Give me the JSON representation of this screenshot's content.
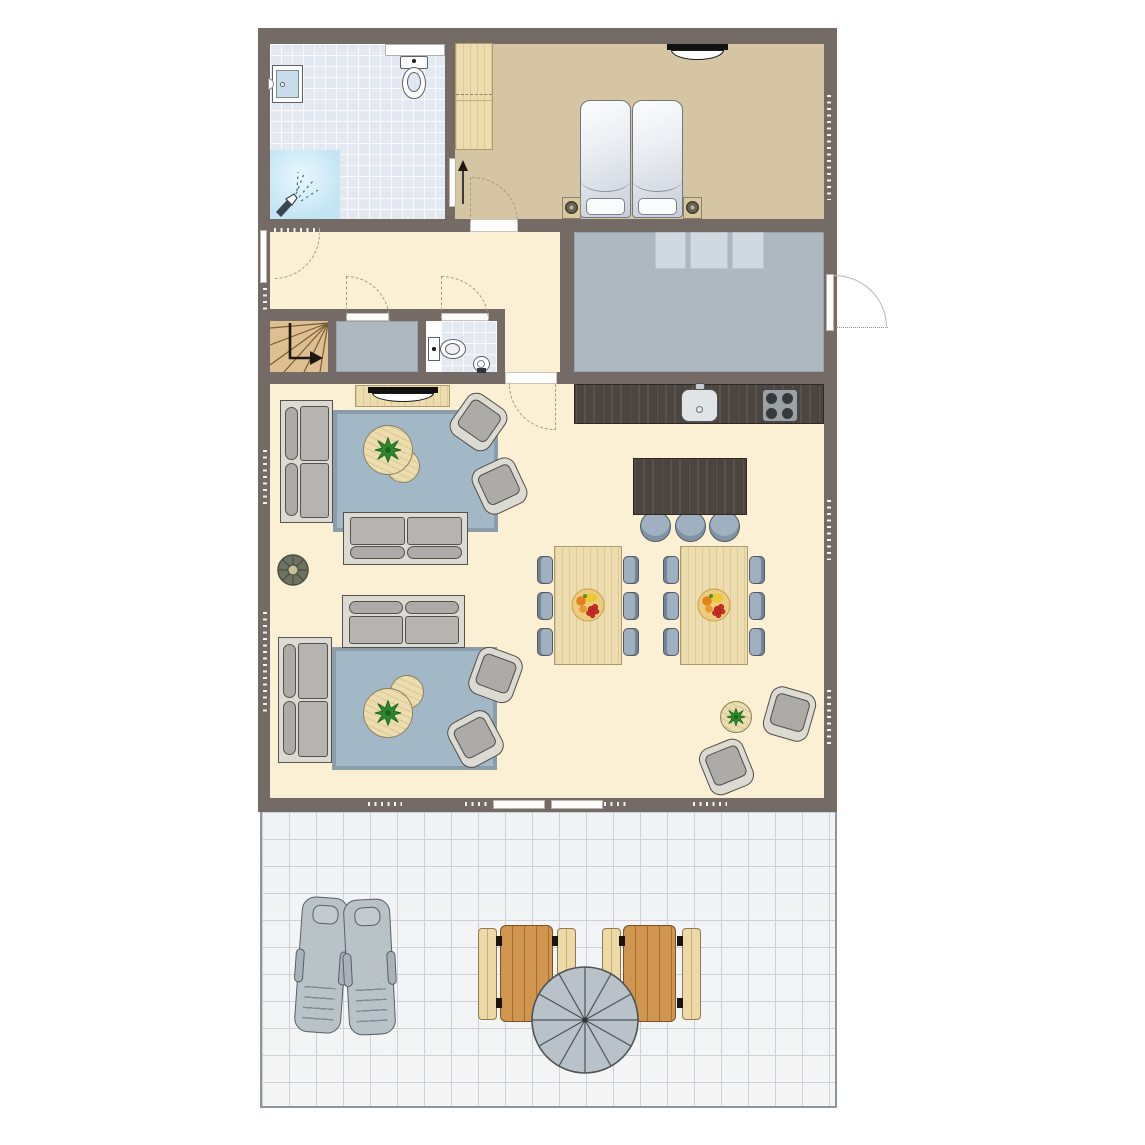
{
  "title": "cottage-floor-plan",
  "palette": {
    "wall": "#746b66",
    "cream": "#fbf0d3",
    "bedroom": "#d5c5a3",
    "bathtile": "#e3e8f1",
    "shower": "#c2e4f4",
    "grayroom": "#aeb8c0",
    "skylight": "#d1d9e0",
    "darkwood": "#4c443e",
    "lightwood": "#ecdcae",
    "stairswood": "#ddbf92",
    "rug": "#a3b8c6",
    "rugborder": "#8b9dab",
    "sofashell": "#dcdbd3",
    "sofacushion": "#adaba7",
    "chair": "#9fb1c0",
    "terraceline": "#ccd1d7",
    "ttable": "#d0954f",
    "bench": "#ecd9a6",
    "parasol": "#b9c2c8",
    "lounger": "#b9c2c7",
    "plantgreen": "#2e8a2c",
    "plate": "#edcb7f"
  },
  "rooms": [
    {
      "id": "bathroom",
      "features": [
        "shower",
        "toilet",
        "shelf",
        "washing-machine"
      ]
    },
    {
      "id": "bedroom",
      "features": [
        "double-bed",
        "two-nightstands-with-lamps",
        "wardrobe",
        "wall-tv"
      ]
    },
    {
      "id": "hallway",
      "features": [
        "winder-stairs",
        "window"
      ]
    },
    {
      "id": "storage-room",
      "features": []
    },
    {
      "id": "wc",
      "features": [
        "toilet",
        "corner-sink"
      ]
    },
    {
      "id": "utility-room",
      "features": [
        "shelf-units",
        "entrance-door"
      ]
    },
    {
      "id": "living-dining-kitchen",
      "features": [
        "kitchen-counter-sink-hob",
        "island-with-3-stools",
        "2-dining-tables-6-chairs-each",
        "2-sofa-groups-with-rugs",
        "tv-sideboard",
        "reading-corner"
      ]
    },
    {
      "id": "terrace",
      "features": [
        "2-sun-loungers",
        "2-picnic-tables-with-benches",
        "parasol",
        "double-door"
      ]
    }
  ],
  "counts": {
    "dining_chairs": 12,
    "bar_stools": 3,
    "armchairs": 6,
    "sofas": 4,
    "sun_loungers": 2,
    "picnic_benches": 4
  }
}
